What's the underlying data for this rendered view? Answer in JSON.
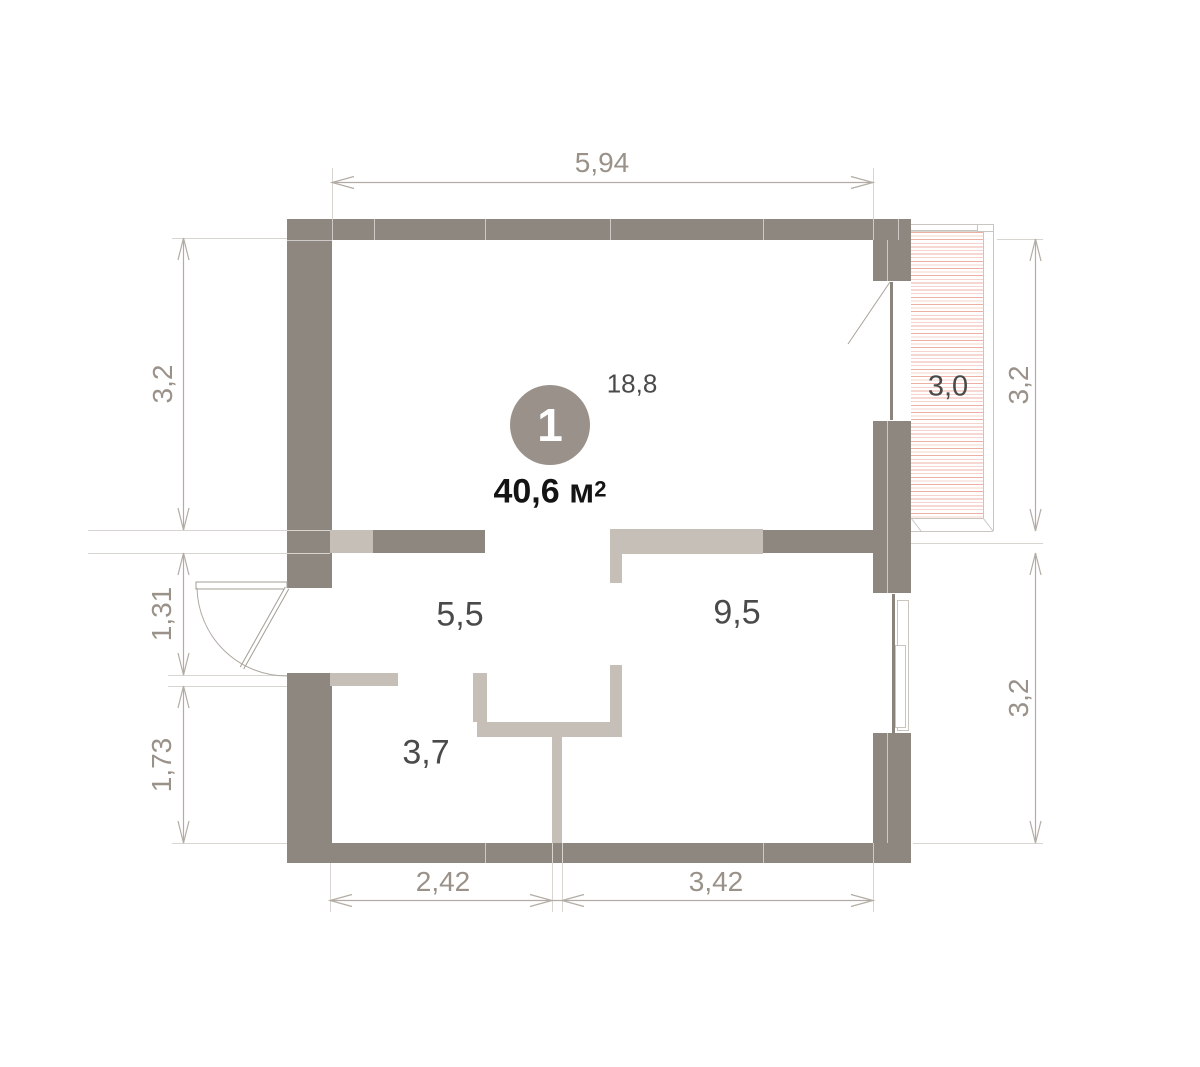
{
  "plan": {
    "unit_number": "1",
    "area_value": "40,6",
    "area_unit": "м",
    "area_sup": "2"
  },
  "rooms": [
    {
      "name": "living-room",
      "label": "18,8"
    },
    {
      "name": "hallway",
      "label": "5,5"
    },
    {
      "name": "room",
      "label": "9,5"
    },
    {
      "name": "bathroom",
      "label": "3,7"
    },
    {
      "name": "balcony",
      "label": "3,0"
    }
  ],
  "dimensions": {
    "top": "5,94",
    "left_upper": "3,2",
    "left_middle": "1,31",
    "left_lower": "1,73",
    "right_upper": "3,2",
    "right_lower": "3,2",
    "bottom_left": "2,42",
    "bottom_right": "3,42"
  },
  "colors": {
    "wall": "#8e8780",
    "partition": "#c5bfb8",
    "hatch_line": "#eeafa5",
    "dimension_text": "#9a9189",
    "room_text": "#4a4a49",
    "circle_fill": "#9a918a"
  }
}
